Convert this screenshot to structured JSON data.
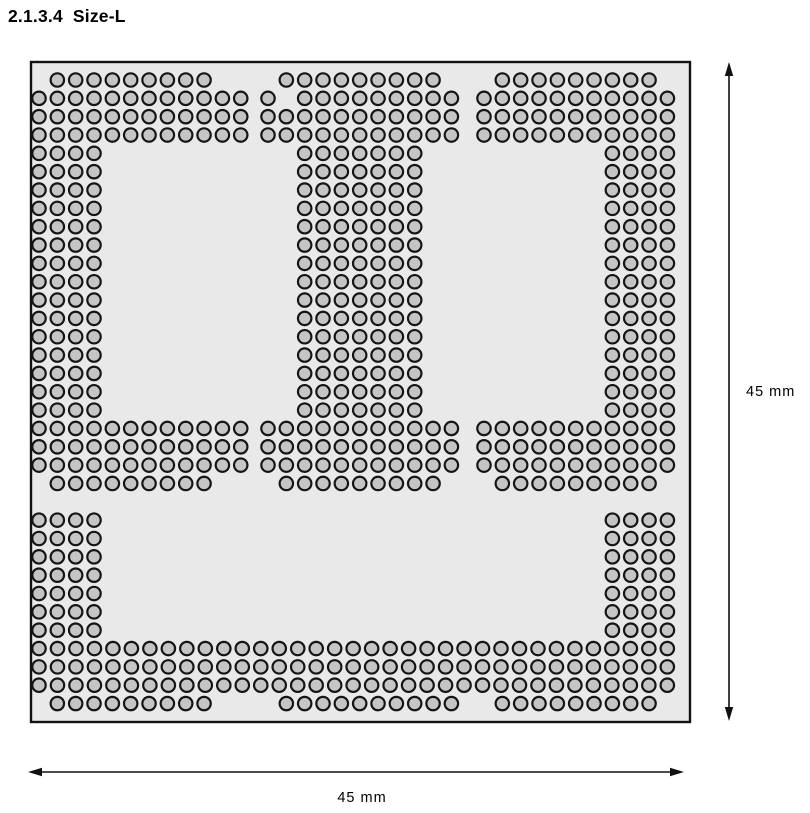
{
  "title": {
    "number": "2.1.3.4",
    "name": "Size-L"
  },
  "dimensions": {
    "width_label": "45 mm",
    "height_label": "45 mm",
    "package_width_mm": 45,
    "package_height_mm": 45
  },
  "colors": {
    "background": "#ffffff",
    "package_fill": "#e9e9e9",
    "package_stroke": "#121212",
    "ball_fill": "#c5c5c5",
    "ball_stroke": "#151515",
    "dimension_color": "#111111",
    "text_color": "#000000"
  },
  "ball_grid": {
    "pitch": 18.34,
    "ball_radius": 6.7,
    "ball_stroke_width": 2.2,
    "row_origin_y": 80,
    "package": {
      "x": 31,
      "y": 62,
      "width": 659,
      "height": 660
    },
    "block_origins_x": {
      "L": 39,
      "C": 268,
      "R": 484
    },
    "full_row": {
      "origin_x": 39,
      "pitch": 18.48
    },
    "row_groups": [
      {
        "from": 0,
        "to": 0,
        "segments": [
          [
            "L",
            1,
            9
          ],
          [
            "C",
            1,
            9
          ],
          [
            "R",
            1,
            9
          ]
        ]
      },
      {
        "from": 1,
        "to": 1,
        "segments": [
          [
            "L",
            0,
            12
          ],
          [
            "C",
            0,
            1
          ],
          [
            "C",
            2,
            9
          ],
          [
            "R",
            0,
            11
          ]
        ]
      },
      {
        "from": 2,
        "to": 3,
        "segments": [
          [
            "L",
            0,
            12
          ],
          [
            "C",
            0,
            11
          ],
          [
            "R",
            0,
            11
          ]
        ]
      },
      {
        "from": 4,
        "to": 18,
        "segments": [
          [
            "L",
            0,
            4
          ],
          [
            "C",
            2,
            7
          ],
          [
            "R",
            7,
            4
          ]
        ]
      },
      {
        "from": 19,
        "to": 21,
        "segments": [
          [
            "L",
            0,
            12
          ],
          [
            "C",
            0,
            11
          ],
          [
            "R",
            0,
            11
          ]
        ]
      },
      {
        "from": 22,
        "to": 22,
        "segments": [
          [
            "L",
            1,
            9
          ],
          [
            "C",
            1,
            9
          ],
          [
            "R",
            1,
            9
          ]
        ]
      },
      {
        "from": 24,
        "to": 30,
        "segments": [
          [
            "L",
            0,
            4
          ],
          [
            "R",
            7,
            4
          ]
        ]
      },
      {
        "from": 31,
        "to": 33,
        "segments": [
          [
            "F",
            0,
            35
          ]
        ]
      },
      {
        "from": 34,
        "to": 34,
        "segments": [
          [
            "L",
            1,
            9
          ],
          [
            "C",
            1,
            10
          ],
          [
            "R",
            1,
            9
          ]
        ]
      }
    ]
  },
  "annotations": {
    "vertical_arrow": {
      "x": 729,
      "y1": 62,
      "y2": 721
    },
    "horizontal_arrow": {
      "y": 772,
      "x1": 28,
      "x2": 684
    },
    "vertical_label_pos": {
      "x": 746,
      "y": 396
    },
    "horizontal_label_pos": {
      "x": 362,
      "y": 802
    }
  }
}
